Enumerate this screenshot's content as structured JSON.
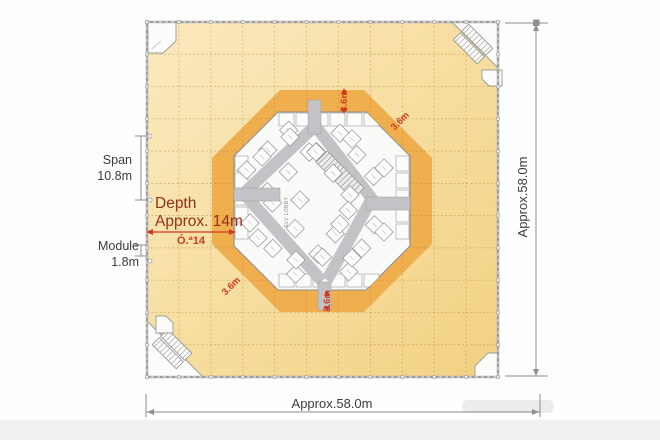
{
  "colors": {
    "floor_light": "#FAEAC0",
    "floor": "#F7DFA3",
    "floor_deep": "#F2D183",
    "band": "#F0AF4F",
    "core": "#FAFAF8",
    "corridor": "#C3C3C7",
    "border": "#9E9E9E",
    "dim_line": "#8C8C8C",
    "red": "#D03A1E",
    "maroon": "#943018",
    "text": "#3B3B3B"
  },
  "annotations": {
    "span": {
      "line1": "Span",
      "line2": "10.8m"
    },
    "depth": {
      "line1": "Depth",
      "line2": "Approx. 14m",
      "arrow_label": "Ó.ª14"
    },
    "module": {
      "line1": "Module",
      "line2": "1.8m"
    },
    "right_dim": "Approx.58.0m",
    "bottom_dim": "Approx.58.0m",
    "band_dims": {
      "top": "3.6m",
      "top_right": "3.6m",
      "bottom": "3.6m",
      "bottom_left": "3.6m"
    }
  },
  "core_labels": {
    "elv_lobby": "ELV LOBBY"
  }
}
